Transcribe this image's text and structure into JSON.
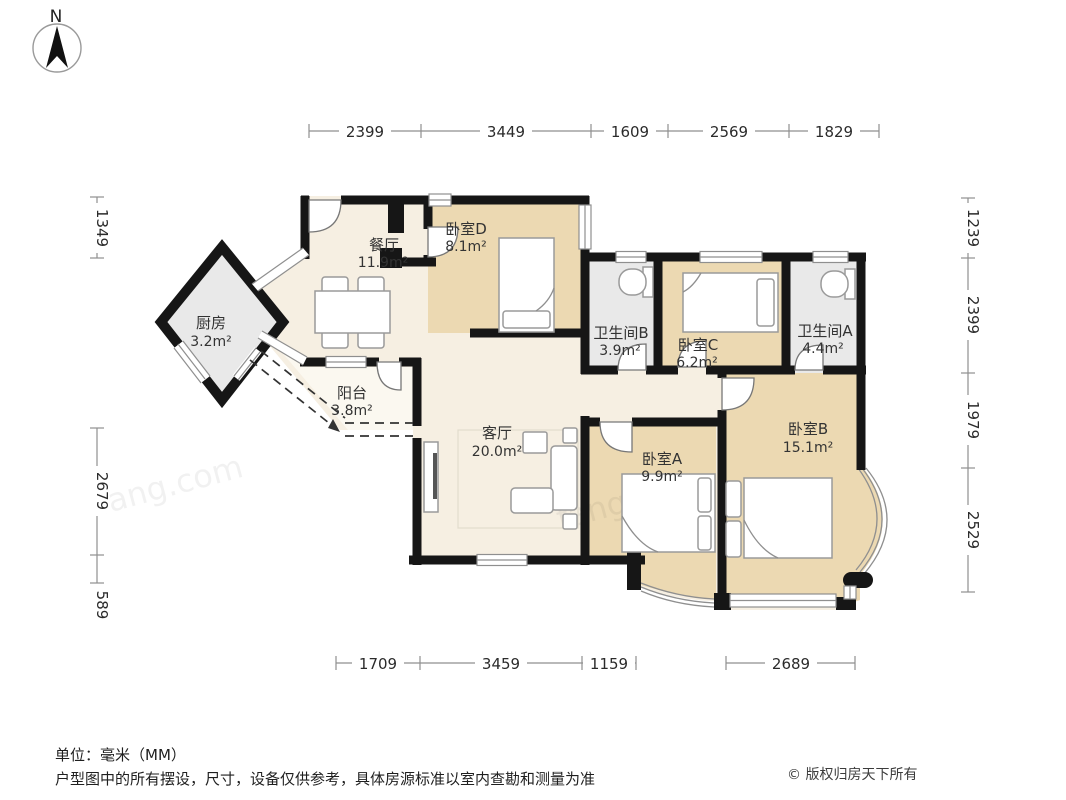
{
  "compass": {
    "label": "N"
  },
  "rooms": {
    "dining": {
      "name": "餐厅",
      "area": "11.9m²"
    },
    "kitchen": {
      "name": "厨房",
      "area": "3.2m²"
    },
    "balcony": {
      "name": "阳台",
      "area": "3.8m²"
    },
    "living": {
      "name": "客厅",
      "area": "20.0m²"
    },
    "bedroom_d": {
      "name": "卧室D",
      "area": "8.1m²"
    },
    "bathroom_b": {
      "name": "卫生间B",
      "area": "3.9m²"
    },
    "bedroom_c": {
      "name": "卧室C",
      "area": "6.2m²"
    },
    "bathroom_a": {
      "name": "卫生间A",
      "area": "4.4m²"
    },
    "bedroom_a": {
      "name": "卧室A",
      "area": "9.9m²"
    },
    "bedroom_b": {
      "name": "卧室B",
      "area": "15.1m²"
    }
  },
  "dimensions_mm": {
    "top": [
      "2399",
      "3449",
      "1609",
      "2569",
      "1829"
    ],
    "bottom": [
      "1709",
      "3459",
      "1159",
      "2689"
    ],
    "left": [
      "1349",
      "2679",
      "589"
    ],
    "right": [
      "1239",
      "2399",
      "1979",
      "2529"
    ]
  },
  "footer": {
    "unit_note": "单位：毫米（MM）",
    "disclaimer": "户型图中的所有摆设，尺寸，设备仅供参考，具体房源标准以室内查勘和测量为准",
    "copyright": "© 版权归房天下所有"
  },
  "watermark": "fang.com",
  "colors": {
    "wall": "#161616",
    "room_warm": "#ecd9b2",
    "room_light": "#f6efe2",
    "room_gray": "#e9e9e9",
    "balcony": "#fbf8f0",
    "page_bg": "#ffffff"
  }
}
